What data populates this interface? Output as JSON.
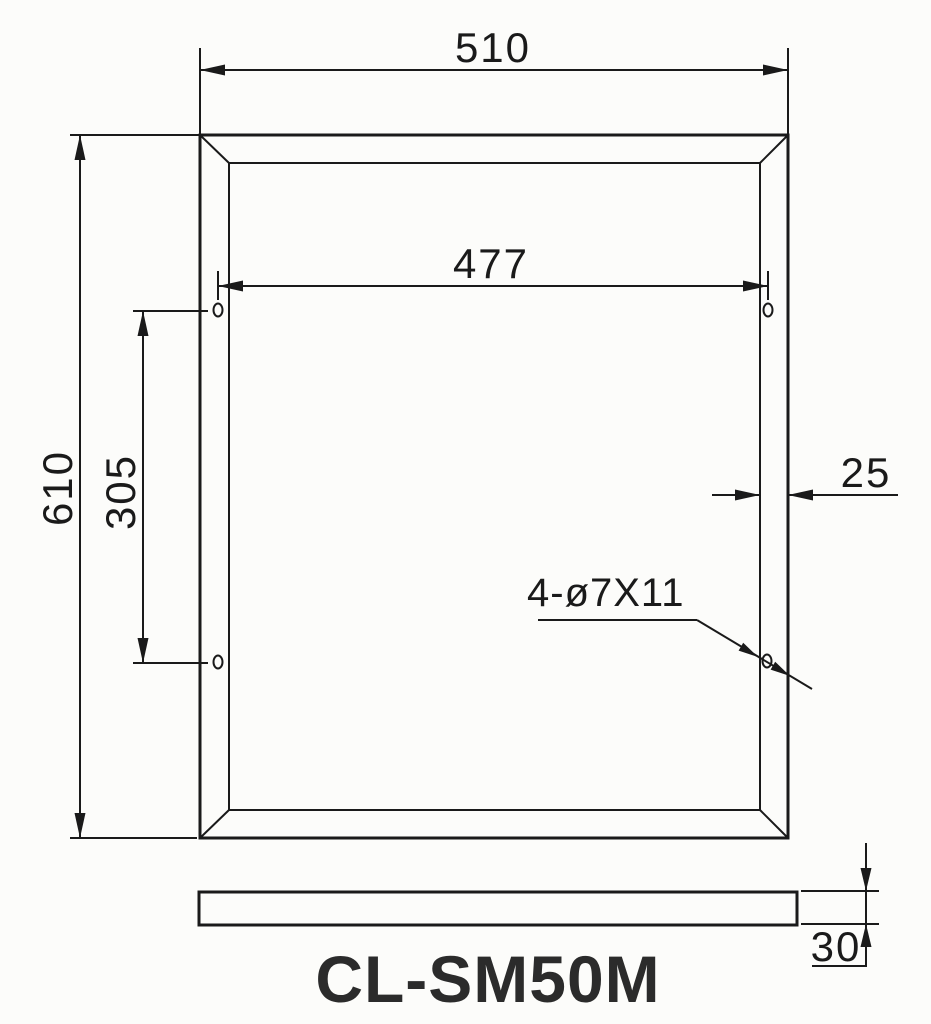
{
  "title": {
    "model": "CL-SM50M"
  },
  "dimensions": {
    "outer_width": "510",
    "hole_span_width": "477",
    "outer_height": "610",
    "hole_span_height": "305",
    "frame_face_width": "25",
    "hole_callout": "4-ø7X11",
    "side_thickness": "30"
  },
  "colors": {
    "line": "#1a1a1a",
    "title_text": "#2b2b2b",
    "background": "#fcfcfa"
  }
}
